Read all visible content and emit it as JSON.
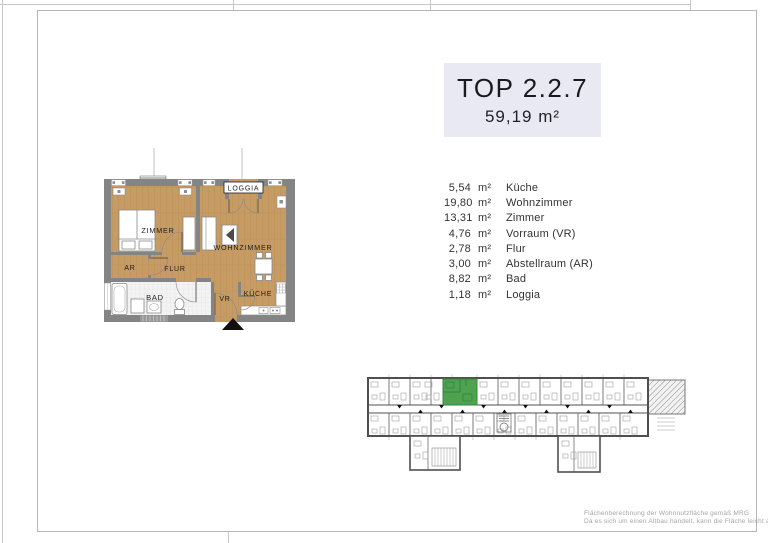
{
  "header": {
    "title": "TOP 2.2.7",
    "area": "59,19 m²"
  },
  "rooms": [
    {
      "area": "5,54",
      "unit": "m²",
      "name": "Küche"
    },
    {
      "area": "19,80",
      "unit": "m²",
      "name": "Wohnzimmer"
    },
    {
      "area": "13,31",
      "unit": "m²",
      "name": "Zimmer"
    },
    {
      "area": "4,76",
      "unit": "m²",
      "name": "Vorraum (VR)"
    },
    {
      "area": "2,78",
      "unit": "m²",
      "name": "Flur"
    },
    {
      "area": "3,00",
      "unit": "m²",
      "name": "Abstellraum (AR)"
    },
    {
      "area": "8,82",
      "unit": "m²",
      "name": "Bad"
    },
    {
      "area": "1,18",
      "unit": "m²",
      "name": "Loggia"
    }
  ],
  "floorplan_labels": {
    "zimmer": "ZIMMER",
    "wohnzimmer": "WOHNZIMMER",
    "flur": "FLUR",
    "ar": "AR",
    "bad": "BAD",
    "vr": "VR",
    "kueche": "KÜCHE",
    "loggia": "LOGGIA"
  },
  "footnote": {
    "line1": "Flächenberechnung der Wohnnutzfläche gemäß MRG",
    "line2": "Da es sich um einen Altbau handelt, kann die Fläche leicht abweichen"
  },
  "colors": {
    "wood_floor": "#c79b64",
    "wall_grey": "#848484",
    "tile_floor": "#f3f3f3",
    "highlight_green": "#4fa24f",
    "title_background": "#e9e9f3"
  }
}
